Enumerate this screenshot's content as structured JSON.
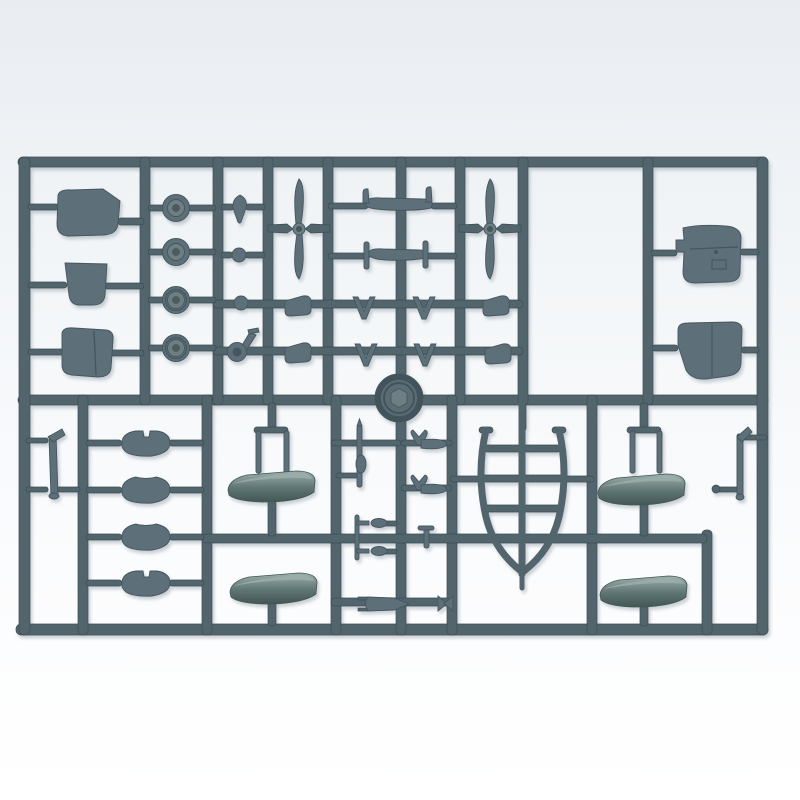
{
  "scene": {
    "type": "photograph",
    "subject": "grey-green plastic model kit sprue with aircraft parts on white background"
  },
  "colors": {
    "bg_top": "#e9edf2",
    "bg_upper": "#f3f6f8",
    "bg_lower": "#fbfcfd",
    "bg_bottom": "#ffffff",
    "runner": "#53656c",
    "runner_dark": "#3c4c54",
    "runner_light": "#7a8d94",
    "part": "#5d6f78",
    "part_dark": "#46565e",
    "part_light": "#7b8b91",
    "metal_light": "#9db0ad",
    "metal": "#5f7573",
    "metal_dark": "#435755",
    "hub_face": "#6e7e81",
    "wheel_rim": "#42535b",
    "wheel_face": "#5b6d74"
  },
  "parts": {
    "labels": [
      "hatch-panels",
      "wheel-hubs",
      "fuel-cap",
      "small-balls",
      "tail-wheel",
      "two-blade-propellers",
      "bomb-spindle",
      "axle-spindle",
      "v-struts",
      "intake-blocks",
      "main-wheel",
      "wheel-halves",
      "floats",
      "float-struts",
      "keel-frame",
      "pitot-rods",
      "wheel-forks",
      "small-bomb",
      "tail-fin",
      "access-panels",
      "gear-legs"
    ]
  }
}
